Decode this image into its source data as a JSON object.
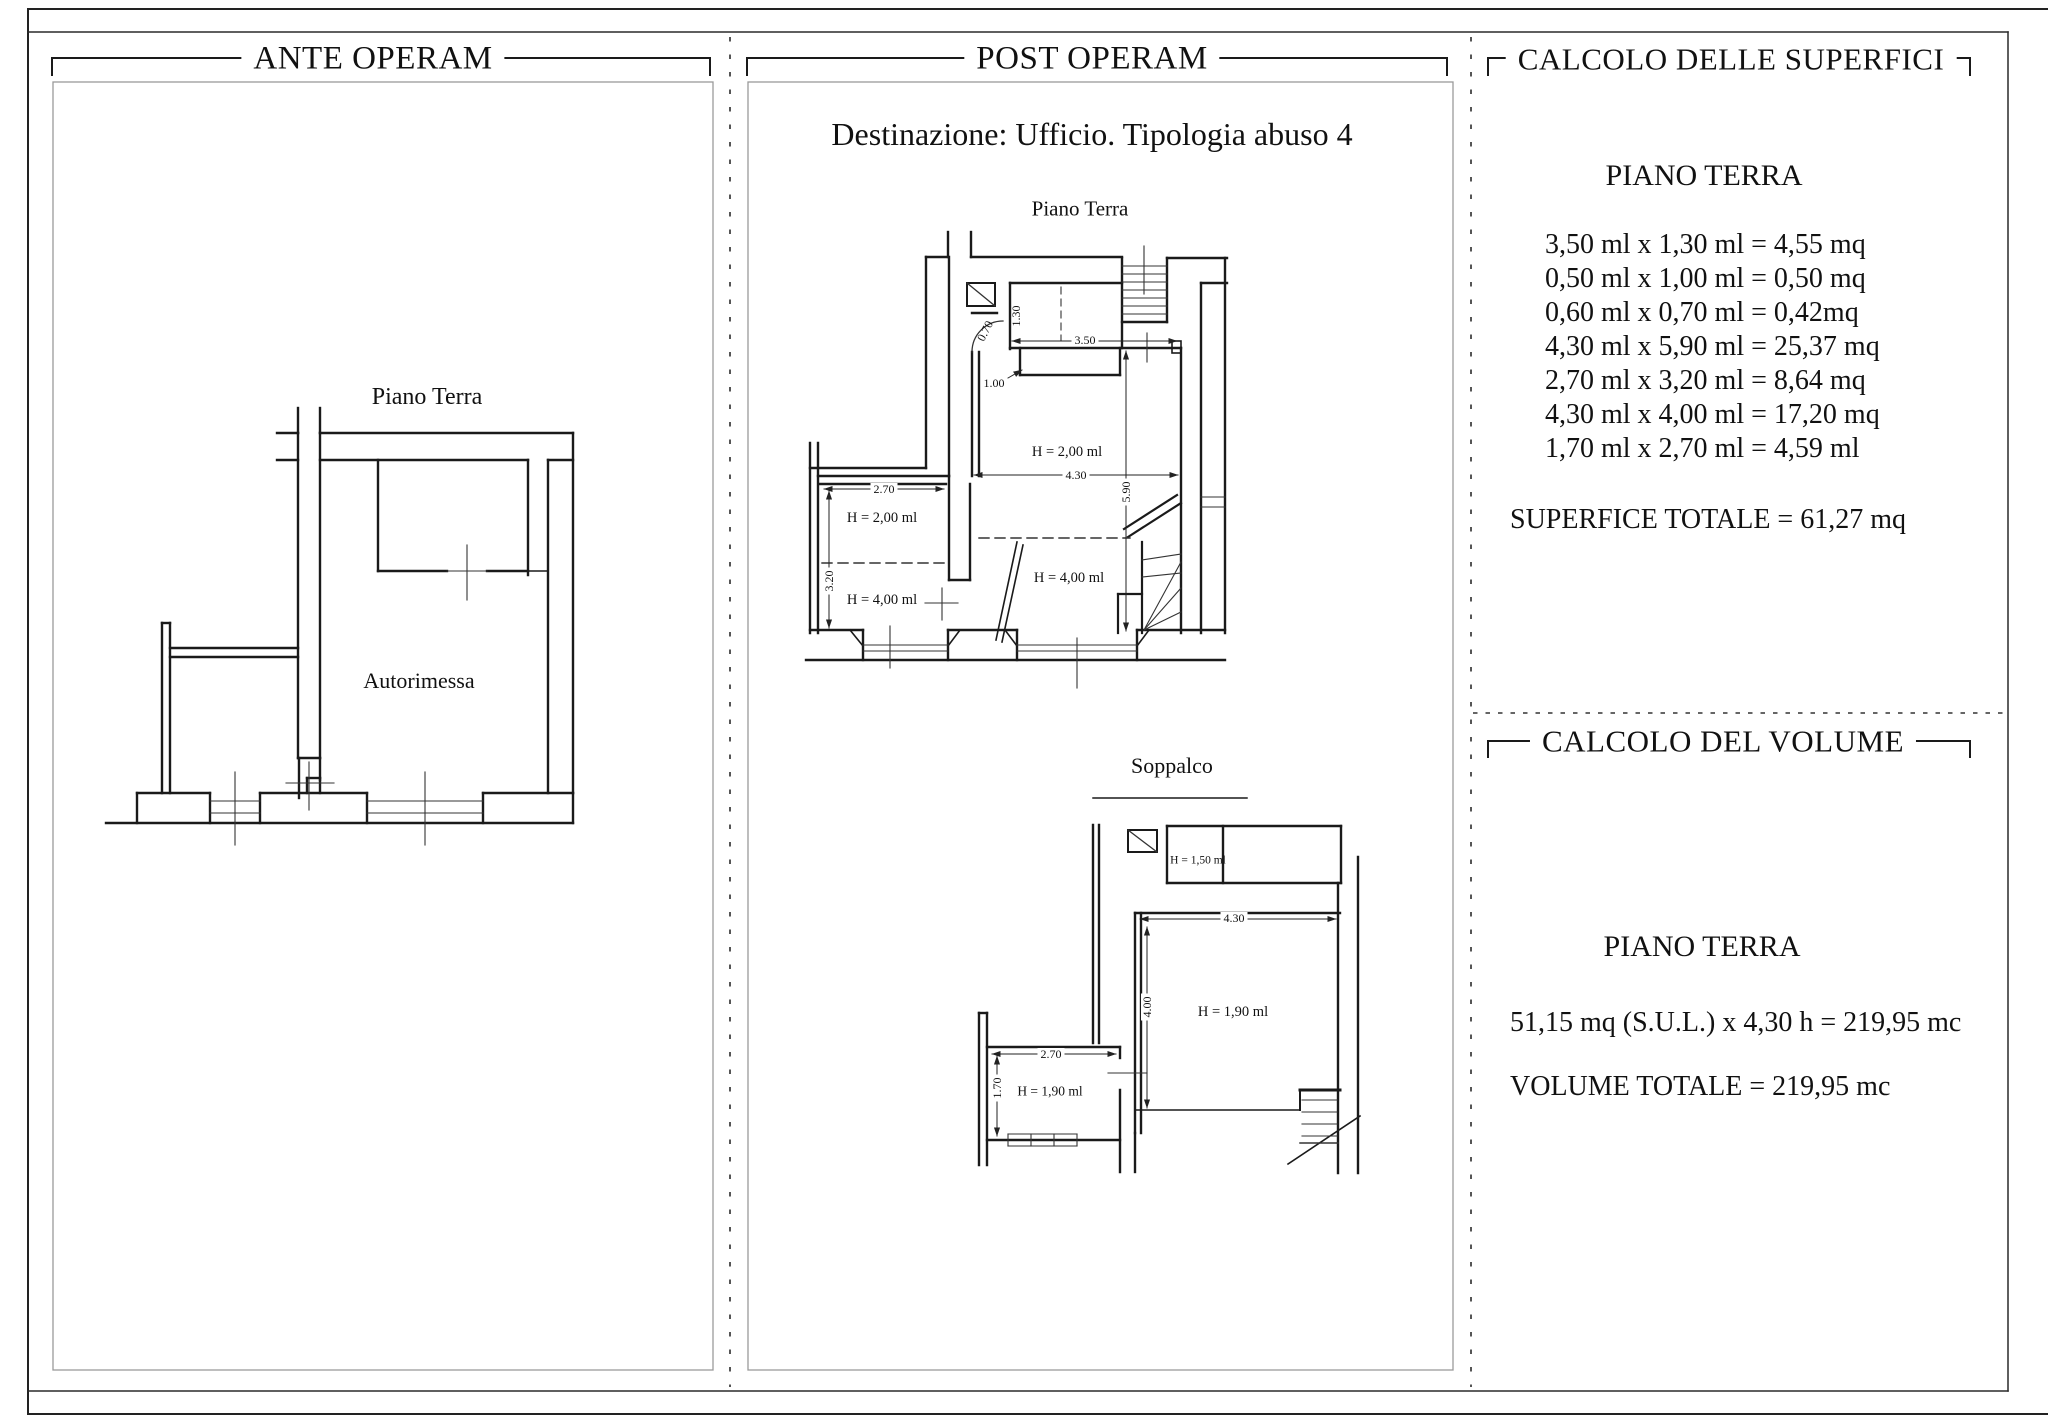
{
  "panels": {
    "ante": {
      "title": "ANTE OPERAM",
      "plan_label": "Piano Terra",
      "room_label": "Autorimessa"
    },
    "post": {
      "title": "POST OPERAM",
      "subtitle": "Destinazione: Ufficio. Tipologia abuso 4",
      "piano_terra": {
        "label": "Piano Terra",
        "dim_130": "1.30",
        "dim_070": "0.70",
        "dim_350": "3.50",
        "dim_100": "1.00",
        "dim_430": "4.30",
        "dim_590": "5.90",
        "dim_270": "2.70",
        "dim_320": "3.20",
        "h_main": "H = 2,00 ml",
        "h_left_upper": "H = 2,00 ml",
        "h_left_lower": "H = 4,00 ml",
        "h_right_lower": "H = 4,00 ml"
      },
      "soppalco": {
        "label": "Soppalco",
        "h_top": "H = 1,50 ml",
        "dim_430": "4.30",
        "dim_400": "4.00",
        "h_main": "H = 1,90 ml",
        "dim_270": "2.70",
        "dim_170": "1.70",
        "h_left": "H = 1,90 ml"
      }
    },
    "calcolo": {
      "superfici": {
        "title": "CALCOLO DELLE SUPERFICI",
        "heading": "PIANO TERRA",
        "rows": [
          "3,50 ml x 1,30 ml = 4,55 mq",
          "0,50 ml x 1,00 ml = 0,50 mq",
          "0,60 ml x 0,70 ml = 0,42mq",
          "4,30 ml x 5,90 ml = 25,37 mq",
          "2,70 ml x 3,20 ml = 8,64 mq",
          "4,30 ml x 4,00 ml = 17,20 mq",
          "1,70 ml x 2,70 ml = 4,59 ml"
        ],
        "total": "SUPERFICE TOTALE = 61,27 mq"
      },
      "volume": {
        "title": "CALCOLO DEL VOLUME",
        "heading": "PIANO TERRA",
        "formula": "51,15 mq (S.U.L.) x 4,30 h = 219,95 mc",
        "total": "VOLUME TOTALE = 219,95 mc"
      }
    }
  }
}
